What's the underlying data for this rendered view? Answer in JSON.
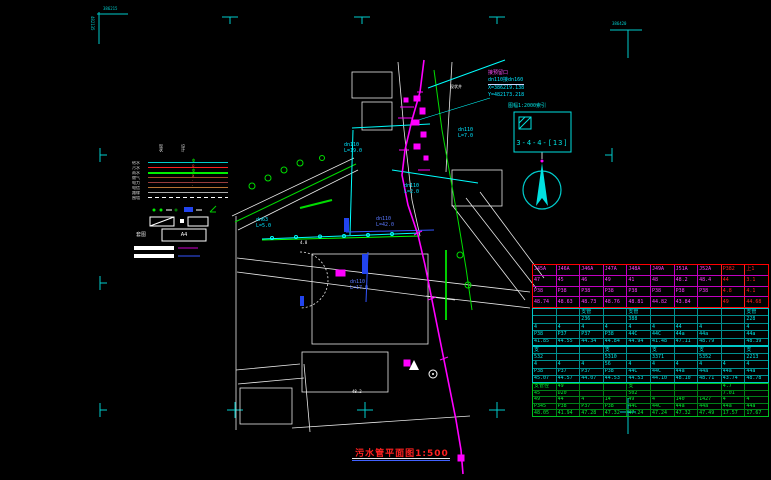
{
  "title_block": {
    "text": "污水管平面图1:500"
  },
  "index_box": {
    "caption": "图幅1:2000索引",
    "label": "3-4-4-[13]"
  },
  "annotation": {
    "line1": "接预留口",
    "line2": "dn110接dn160",
    "line3": "X=386219.138",
    "line4": "Y=482173.218"
  },
  "legend": {
    "header_current": "现状",
    "header_design": "设计",
    "frame_label": "套图",
    "frame_value": "A4",
    "rows": [
      {
        "label": "给水",
        "color": "#00cccc",
        "style": "solid",
        "glyph": "Φ",
        "glyph_color": "#00ff00"
      },
      {
        "label": "污水",
        "color": "#ff2020",
        "style": "solid",
        "glyph": "o",
        "glyph_color": "#ff4040"
      },
      {
        "label": "雨水",
        "color": "#00ee00",
        "style": "solid",
        "glyph": "Φ",
        "glyph_color": "#00ff00",
        "thick": true
      },
      {
        "label": "燃气",
        "color": "#a04828",
        "style": "solid",
        "glyph": "x",
        "glyph_color": "#ff8040"
      },
      {
        "label": "电力",
        "color": "#963c3c",
        "style": "solid",
        "glyph": "·",
        "glyph_color": "#ff6060"
      },
      {
        "label": "电信",
        "color": "#b87333",
        "style": "solid",
        "glyph": "·",
        "glyph_color": "#ffa050"
      },
      {
        "label": "路缘",
        "color": "#aaaaaa",
        "style": "solid",
        "glyph": "",
        "glyph_color": ""
      },
      {
        "label": "围墙",
        "color": "#ffffff",
        "style": "dashed",
        "glyph": "",
        "glyph_color": ""
      }
    ]
  },
  "pipe_labels": [
    {
      "t": "dn110",
      "x": 344,
      "y": 143,
      "c": "#00e5ff"
    },
    {
      "t": "L=19.0",
      "x": 344,
      "y": 149,
      "c": "#00e5ff"
    },
    {
      "t": "dn110",
      "x": 376,
      "y": 217,
      "c": "#5a78ff"
    },
    {
      "t": "L=42.0",
      "x": 376,
      "y": 223,
      "c": "#5a78ff"
    },
    {
      "t": "dn110",
      "x": 350,
      "y": 280,
      "c": "#5a78ff"
    },
    {
      "t": "L=17.0",
      "x": 350,
      "y": 286,
      "c": "#5a78ff"
    },
    {
      "t": "dn63",
      "x": 256,
      "y": 218,
      "c": "#00e5ff"
    },
    {
      "t": "L=5.0",
      "x": 256,
      "y": 224,
      "c": "#00e5ff"
    },
    {
      "t": "dn110",
      "x": 458,
      "y": 128,
      "c": "#00e5ff"
    },
    {
      "t": "L=7.0",
      "x": 458,
      "y": 134,
      "c": "#00e5ff"
    },
    {
      "t": "dn110",
      "x": 404,
      "y": 184,
      "c": "#00e5ff"
    },
    {
      "t": "L=2.0",
      "x": 404,
      "y": 190,
      "c": "#00e5ff"
    }
  ],
  "map_texts": [
    {
      "t": "现状井",
      "x": 450,
      "y": 85,
      "c": "#ffffff"
    },
    {
      "t": "4.8",
      "x": 300,
      "y": 241,
      "c": "#ffffff"
    },
    {
      "t": "48.2",
      "x": 352,
      "y": 390,
      "c": "#ffffff"
    },
    {
      "t": "386215",
      "x": 103,
      "y": 7,
      "c": "#00cccc"
    },
    {
      "t": "482135",
      "x": 90,
      "y": 16,
      "c": "#00cccc",
      "vert": true
    },
    {
      "t": "386420",
      "x": 612,
      "y": 22,
      "c": "#00cccc"
    }
  ],
  "table": {
    "sections": [
      {
        "color": "#ff40ff",
        "border": "#ff0000",
        "grid": "#c000c0",
        "accent": "#ff2020",
        "accent_cols": [
          8,
          9
        ],
        "rows": [
          [
            "J45A",
            "J46A",
            "J46A",
            "J47A",
            "J48A",
            "J49A",
            "J51A",
            "J52A",
            "P382",
            "上1"
          ],
          [
            "47",
            "45",
            "46",
            "49",
            "41",
            "48",
            "48.2",
            "48.4",
            "44",
            "3.1"
          ],
          [
            "P38",
            "P38",
            "P38",
            "P38",
            "P38",
            "P38",
            "P38",
            "P38",
            "4.8",
            "4.1"
          ],
          [
            "48.74",
            "48.63",
            "48.73",
            "48.76",
            "48.81",
            "44.82",
            "43.84",
            "",
            "49",
            "44.68"
          ]
        ]
      },
      {
        "color": "#00e5e5",
        "border": "#00c8c8",
        "grid": "#008f8f",
        "rows": [
          [
            "",
            "",
            "支管",
            "",
            "支管",
            "",
            "",
            "",
            "",
            "支管"
          ],
          [
            "",
            "",
            "236",
            "",
            "388",
            "",
            "",
            "",
            "",
            "228"
          ],
          [
            "4",
            "4",
            "4",
            "4",
            "4",
            "4",
            "44",
            "4",
            "",
            "4"
          ],
          [
            "P38",
            "P37",
            "P37",
            "P38",
            "44C",
            "44C",
            "44a",
            "44a",
            "",
            "44a"
          ],
          [
            "41.85",
            "44.55",
            "44.34",
            "44.84",
            "44.94",
            "41.48",
            "47.11",
            "48.79",
            "",
            "48.39"
          ]
        ]
      },
      {
        "color": "#00e5e5",
        "border": "#00c8c8",
        "grid": "#008f8f",
        "rows": [
          [
            "支",
            "",
            "",
            "支",
            "",
            "支",
            "",
            "支",
            "",
            "支"
          ],
          [
            "532",
            "",
            "",
            "5310",
            "",
            "3371",
            "",
            "5352",
            "",
            "2213"
          ],
          [
            "4",
            "4",
            "4",
            "56",
            "4",
            "4",
            "4",
            "4",
            "4",
            "4"
          ],
          [
            "P38",
            "P37",
            "P37",
            "P38",
            "44C",
            "44C",
            "44a",
            "44a",
            "44a",
            "44a"
          ],
          [
            "45.07",
            "44.57",
            "44.07",
            "44.53",
            "44.53",
            "44.10",
            "48.10",
            "48.71",
            "43.74",
            "48.78"
          ]
        ]
      },
      {
        "color": "#00ee30",
        "border": "#00c020",
        "grid": "#008018",
        "rows": [
          [
            "支管径",
            "49",
            "",
            "",
            "支",
            "",
            "",
            "",
            "4.7",
            ""
          ],
          [
            "45",
            "D20",
            "",
            "",
            "502",
            "",
            "",
            "",
            "7.01",
            ""
          ],
          [
            "49",
            "44",
            "4",
            "14",
            "49",
            "4",
            "140",
            "1427",
            "4",
            "4"
          ],
          [
            "P345",
            "P38",
            "P37",
            "P38",
            "44C",
            "44C",
            "44a",
            "44a",
            "44a",
            "44a"
          ],
          [
            "48.05",
            "41.94",
            "47.28",
            "47.32",
            "47.24",
            "47.24",
            "47.32",
            "47.49",
            "17.57",
            "17.67"
          ]
        ]
      }
    ]
  }
}
